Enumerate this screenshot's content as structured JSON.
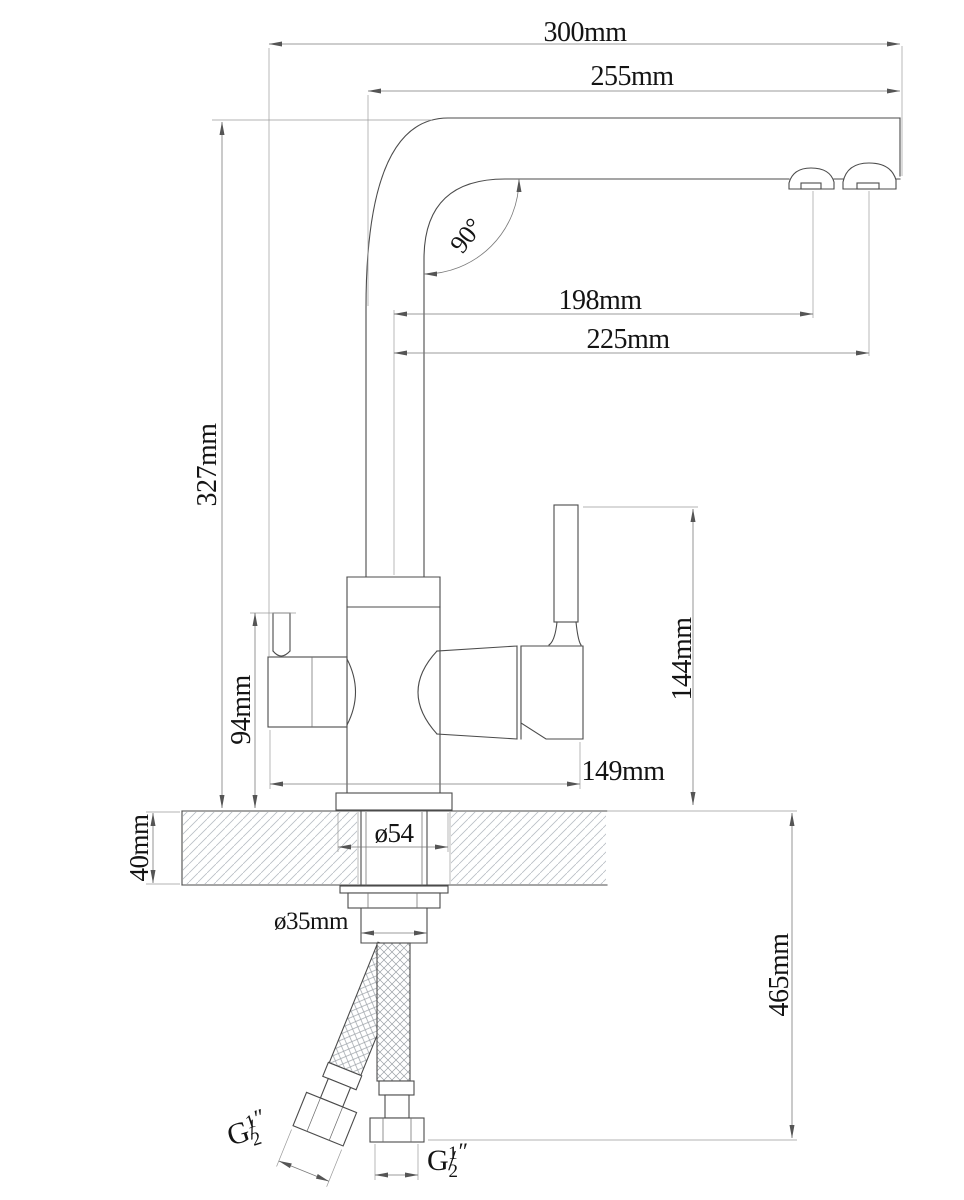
{
  "drawing": {
    "title": "faucet-dimension-drawing",
    "units": "mm",
    "labels": {
      "overall_width": "300mm",
      "spout_reach": "255mm",
      "spout_angle": "90°",
      "outlet_filtered_offset": "198mm",
      "outlet_main_offset": "225mm",
      "height_above_counter": "327mm",
      "valve_height": "94mm",
      "handle_top_height": "144mm",
      "body_span": "149mm",
      "flange_diameter": "ø54",
      "countertop_thickness": "40mm",
      "shank_diameter": "ø35mm",
      "hose_drop": "465mm"
    },
    "thread_label": {
      "prefix": "G",
      "numerator": "1",
      "slash": "/",
      "denominator": "2",
      "unit": "″"
    },
    "colors": {
      "background": "#ffffff",
      "object_line": "#4b4b4b",
      "dimension_line": "#7a7a7a",
      "text": "#141414",
      "hatch": "#b9bec4",
      "braid": "#9aa0a6"
    }
  }
}
